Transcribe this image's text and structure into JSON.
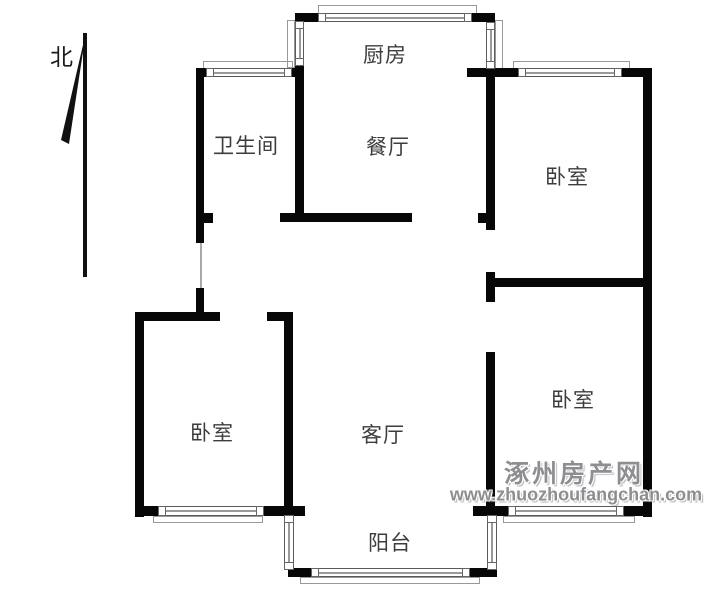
{
  "compass": {
    "label": "北"
  },
  "rooms": {
    "kitchen": {
      "label": "厨房"
    },
    "bathroom": {
      "label": "卫生间"
    },
    "dining": {
      "label": "餐厅"
    },
    "bedroom_top_right": {
      "label": "卧室"
    },
    "bedroom_left": {
      "label": "卧室"
    },
    "bedroom_bottom_right": {
      "label": "卧室"
    },
    "living_room": {
      "label": "客厅"
    },
    "balcony": {
      "label": "阳台"
    }
  },
  "watermark": {
    "site_name": "涿州房产网",
    "site_url": "www.zhuozhoufangchan.com"
  },
  "colors": {
    "wall": "#070707",
    "room_label": "#3d3d3d",
    "watermark": "#8e8e92",
    "window_line": "#9a9a9a",
    "background": "#ffffff"
  }
}
